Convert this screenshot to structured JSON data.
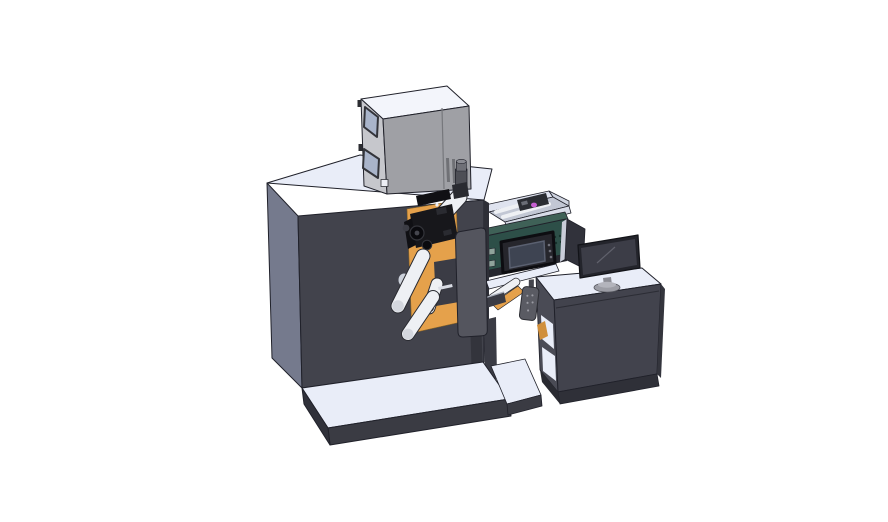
{
  "scene": {
    "description": "Isometric 3D CAD render of a roll-label printing machine: main dark cabinet with a printer unit box on top, exhaust cylinder, unwind rollers with print head, inspection tray with teal finishing unit and HMI display, output chute with hanging applicator, base platforms, and an operator desk with a monitor and side panel",
    "background": "#ffffff"
  },
  "colors": {
    "background": "#ffffff",
    "outline": "#20212a",
    "surface_light": "#e9edf8",
    "surface_seam": "#bcc2d0",
    "cabinet_front": "#42434c",
    "cabinet_left": "#757a8d",
    "cabinet_edge": "#2e2f37",
    "cabinet_hole": "#ccd1db",
    "screw_dark": "#3c3d44",
    "platform_front": "#3a3b43",
    "platform_side": "#30313a",
    "box_top": "#f3f5fb",
    "box_left": "#c6c7cc",
    "box_front": "#9fa0a5",
    "box_frame": "#33343a",
    "box_window": "#a9b4ca",
    "box_seam": "#76777c",
    "box_slot": "#707176",
    "box_hinge": "#2b2c31",
    "box_label": "#eceef4",
    "cyl_body": "#4e4f56",
    "cyl_mid": "#6f7077",
    "cyl_top": "#8a8b92",
    "teal_front": "#2d4f48",
    "teal_top": "#3f6157",
    "teal_side": "#49695f",
    "teal_dot": "#17322c",
    "teal_key": "#8fa39b",
    "hmi_housing": "#26262c",
    "hmi_screen": "#3e4452",
    "hmi_rim": "#5a6070",
    "hmi_button": "#70717b",
    "tray_wall": "#dfe3ef",
    "tray_wall2": "#cfd4e0",
    "tray_floor": "#c2c7d4",
    "tray_inner": "#d8dce8",
    "tray_dark": "#2b2d33",
    "tray_metal": "#6a6d76",
    "magenta": "#c55fd0",
    "roller_white": "#eef0f4",
    "roller_edge": "#2a2b31",
    "roller_shade": "#d4d7de",
    "roller_cap_dark": "#3a3b42",
    "orange": "#e5a14b",
    "orange_edge": "#8a6526",
    "orange_dark": "#d08f3c",
    "column_dark": "#3b3c45",
    "head_black": "#17171b",
    "head_black2": "#101014",
    "head_detail": "#2a2b31",
    "head_knob": "#3c3d45",
    "gear_dark": "#0a0a0e",
    "gear_rim": "#33343a",
    "gear_hub": "#45464e",
    "plate_gray": "#54555e",
    "plate_mark": "#d9dce4",
    "frame_bar": "#3a3b44",
    "frame_hi": "#aab0bc",
    "leg_dark": "#33343c",
    "shadow_band": "#26272e",
    "device_gray": "#5a5b63",
    "device_dot": "#9a9ba3",
    "device_arm": "#44454d",
    "device_edge": "#2c2d33",
    "desk_front": "#42434d",
    "desk_left": "#4a4b55",
    "desk_edge": "#34353d",
    "desk_base": "#2f3038",
    "desk_base2": "#292a31",
    "desk_seam": "#2b2c34",
    "panel_dark": "#31323b",
    "panel_edge": "#c9cdd9",
    "monitor_bezel": "#23242b",
    "monitor_edge": "#121318",
    "monitor_screen": "#3c3d47",
    "monitor_hi": "#60616c",
    "monitor_stand": "#8b8c94",
    "monitor_base": "#9c9da5",
    "monitor_base_edge": "#55565e",
    "monitor_base_hi": "#b3b4bc"
  }
}
